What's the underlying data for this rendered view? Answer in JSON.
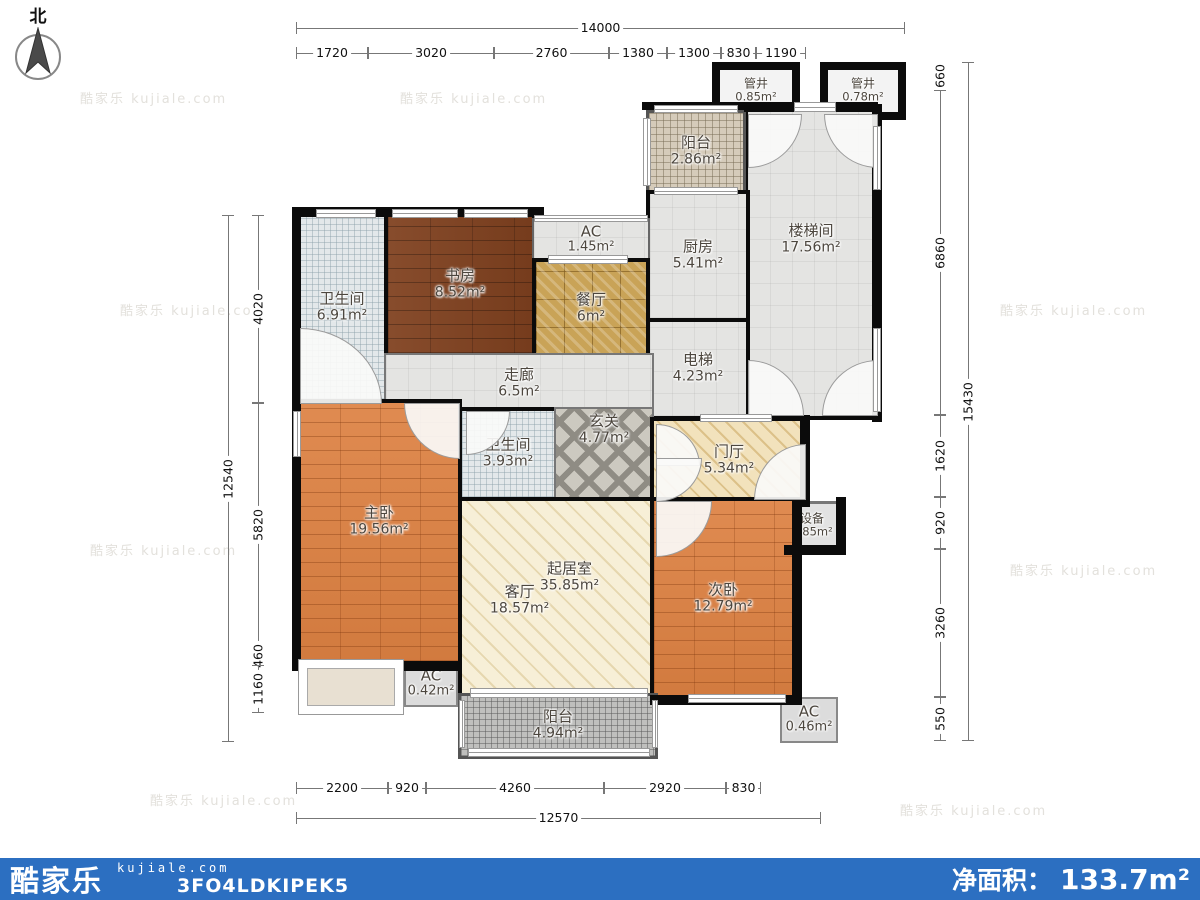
{
  "north_label": "北",
  "watermark": "酷家乐 kujiale.com",
  "rooms": {
    "guanjing1": {
      "label": "管井",
      "area": "0.85m²"
    },
    "guanjing2": {
      "label": "管井",
      "area": "0.78m²"
    },
    "balcony_top": {
      "label": "阳台",
      "area": "2.86m²"
    },
    "kitchen": {
      "label": "厨房",
      "area": "5.41m²"
    },
    "stairwell": {
      "label": "楼梯间",
      "area": "17.56m²"
    },
    "ac_top": {
      "label": "AC",
      "area": "1.45m²"
    },
    "study": {
      "label": "书房",
      "area": "8.52m²"
    },
    "dining": {
      "label": "餐厅",
      "area": "6m²"
    },
    "bath1": {
      "label": "卫生间",
      "area": "6.91m²"
    },
    "corridor": {
      "label": "走廊",
      "area": "6.5m²"
    },
    "elevator": {
      "label": "电梯",
      "area": "4.23m²"
    },
    "xuanguan": {
      "label": "玄关",
      "area": "4.77m²"
    },
    "bath2": {
      "label": "卫生间",
      "area": "3.93m²"
    },
    "menting": {
      "label": "门厅",
      "area": "5.34m²"
    },
    "zhongkong": {
      "label": "中空",
      "area": "0.98m²"
    },
    "shebei": {
      "label": "设备",
      "area": "0.85m²"
    },
    "master": {
      "label": "主卧",
      "area": "19.56m²"
    },
    "qijushi": {
      "label": "起居室",
      "area": "35.85m²"
    },
    "keting": {
      "label": "客厅",
      "area": "18.57m²"
    },
    "second_bed": {
      "label": "次卧",
      "area": "12.79m²"
    },
    "ac_bl": {
      "label": "AC",
      "area": "0.42m²"
    },
    "balcony_bottom": {
      "label": "阳台",
      "area": "4.94m²"
    },
    "ac_br": {
      "label": "AC",
      "area": "0.46m²"
    }
  },
  "dims": {
    "top": {
      "total": "14000",
      "segments": [
        "1720",
        "3020",
        "2760",
        "1380",
        "1300",
        "830",
        "1190"
      ]
    },
    "bottom": {
      "total": "12570",
      "segments": [
        "2200",
        "920",
        "4260",
        "2920",
        "830"
      ]
    },
    "left": {
      "total": "12540",
      "segments": [
        "4020",
        "5820",
        "460",
        "1160"
      ]
    },
    "right": {
      "total": "15430",
      "segments": [
        "660",
        "6860",
        "1620",
        "920",
        "3260",
        "550"
      ]
    }
  },
  "footer": {
    "brand": "酷家乐",
    "url": "kujiale.com",
    "code": "3FO4LDKIPEK5",
    "net_area_label": "净面积：",
    "net_area_value": "133.7m²"
  },
  "colors": {
    "footer_bar": "#2c6fc1",
    "wall": "#0b0b0b"
  }
}
